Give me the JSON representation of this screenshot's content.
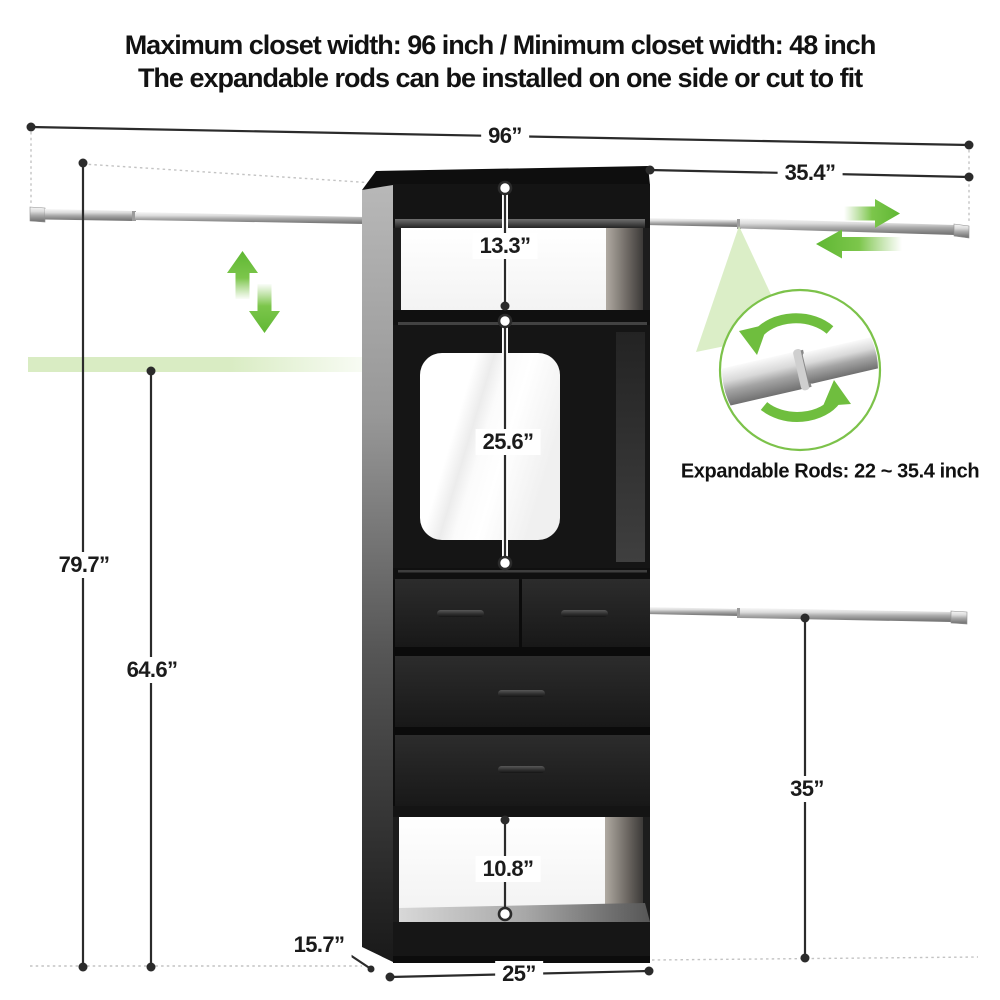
{
  "title": {
    "line1": "Maximum closet width: 96 inch / Minimum closet width: 48 inch",
    "line2": "The expandable rods can be installed on one side or cut to fit"
  },
  "dimensions": {
    "overall_width": "96”",
    "upper_rod_extension": "35.4”",
    "top_shelf_height": "13.3”",
    "middle_compartment_height": "25.6”",
    "total_height": "79.7”",
    "left_rod_height": "64.6”",
    "lower_rod_height": "35”",
    "bottom_compartment_height": "10.8”",
    "unit_depth": "15.7”",
    "unit_width": "25”"
  },
  "callout": {
    "text": "Expandable Rods: 22 ~ 35.4 inch"
  },
  "icons": {
    "expand_vertical": "up-down-arrows",
    "expand_horizontal": "left-right-arrows",
    "rotate_rod": "circular-rotation-arrows"
  },
  "colors": {
    "accent_green": "#6cbf3c",
    "light_green_band": "#d9ecc3",
    "dimension_line": "#2b2b2b",
    "cabinet_black": "#1d1d1d"
  }
}
